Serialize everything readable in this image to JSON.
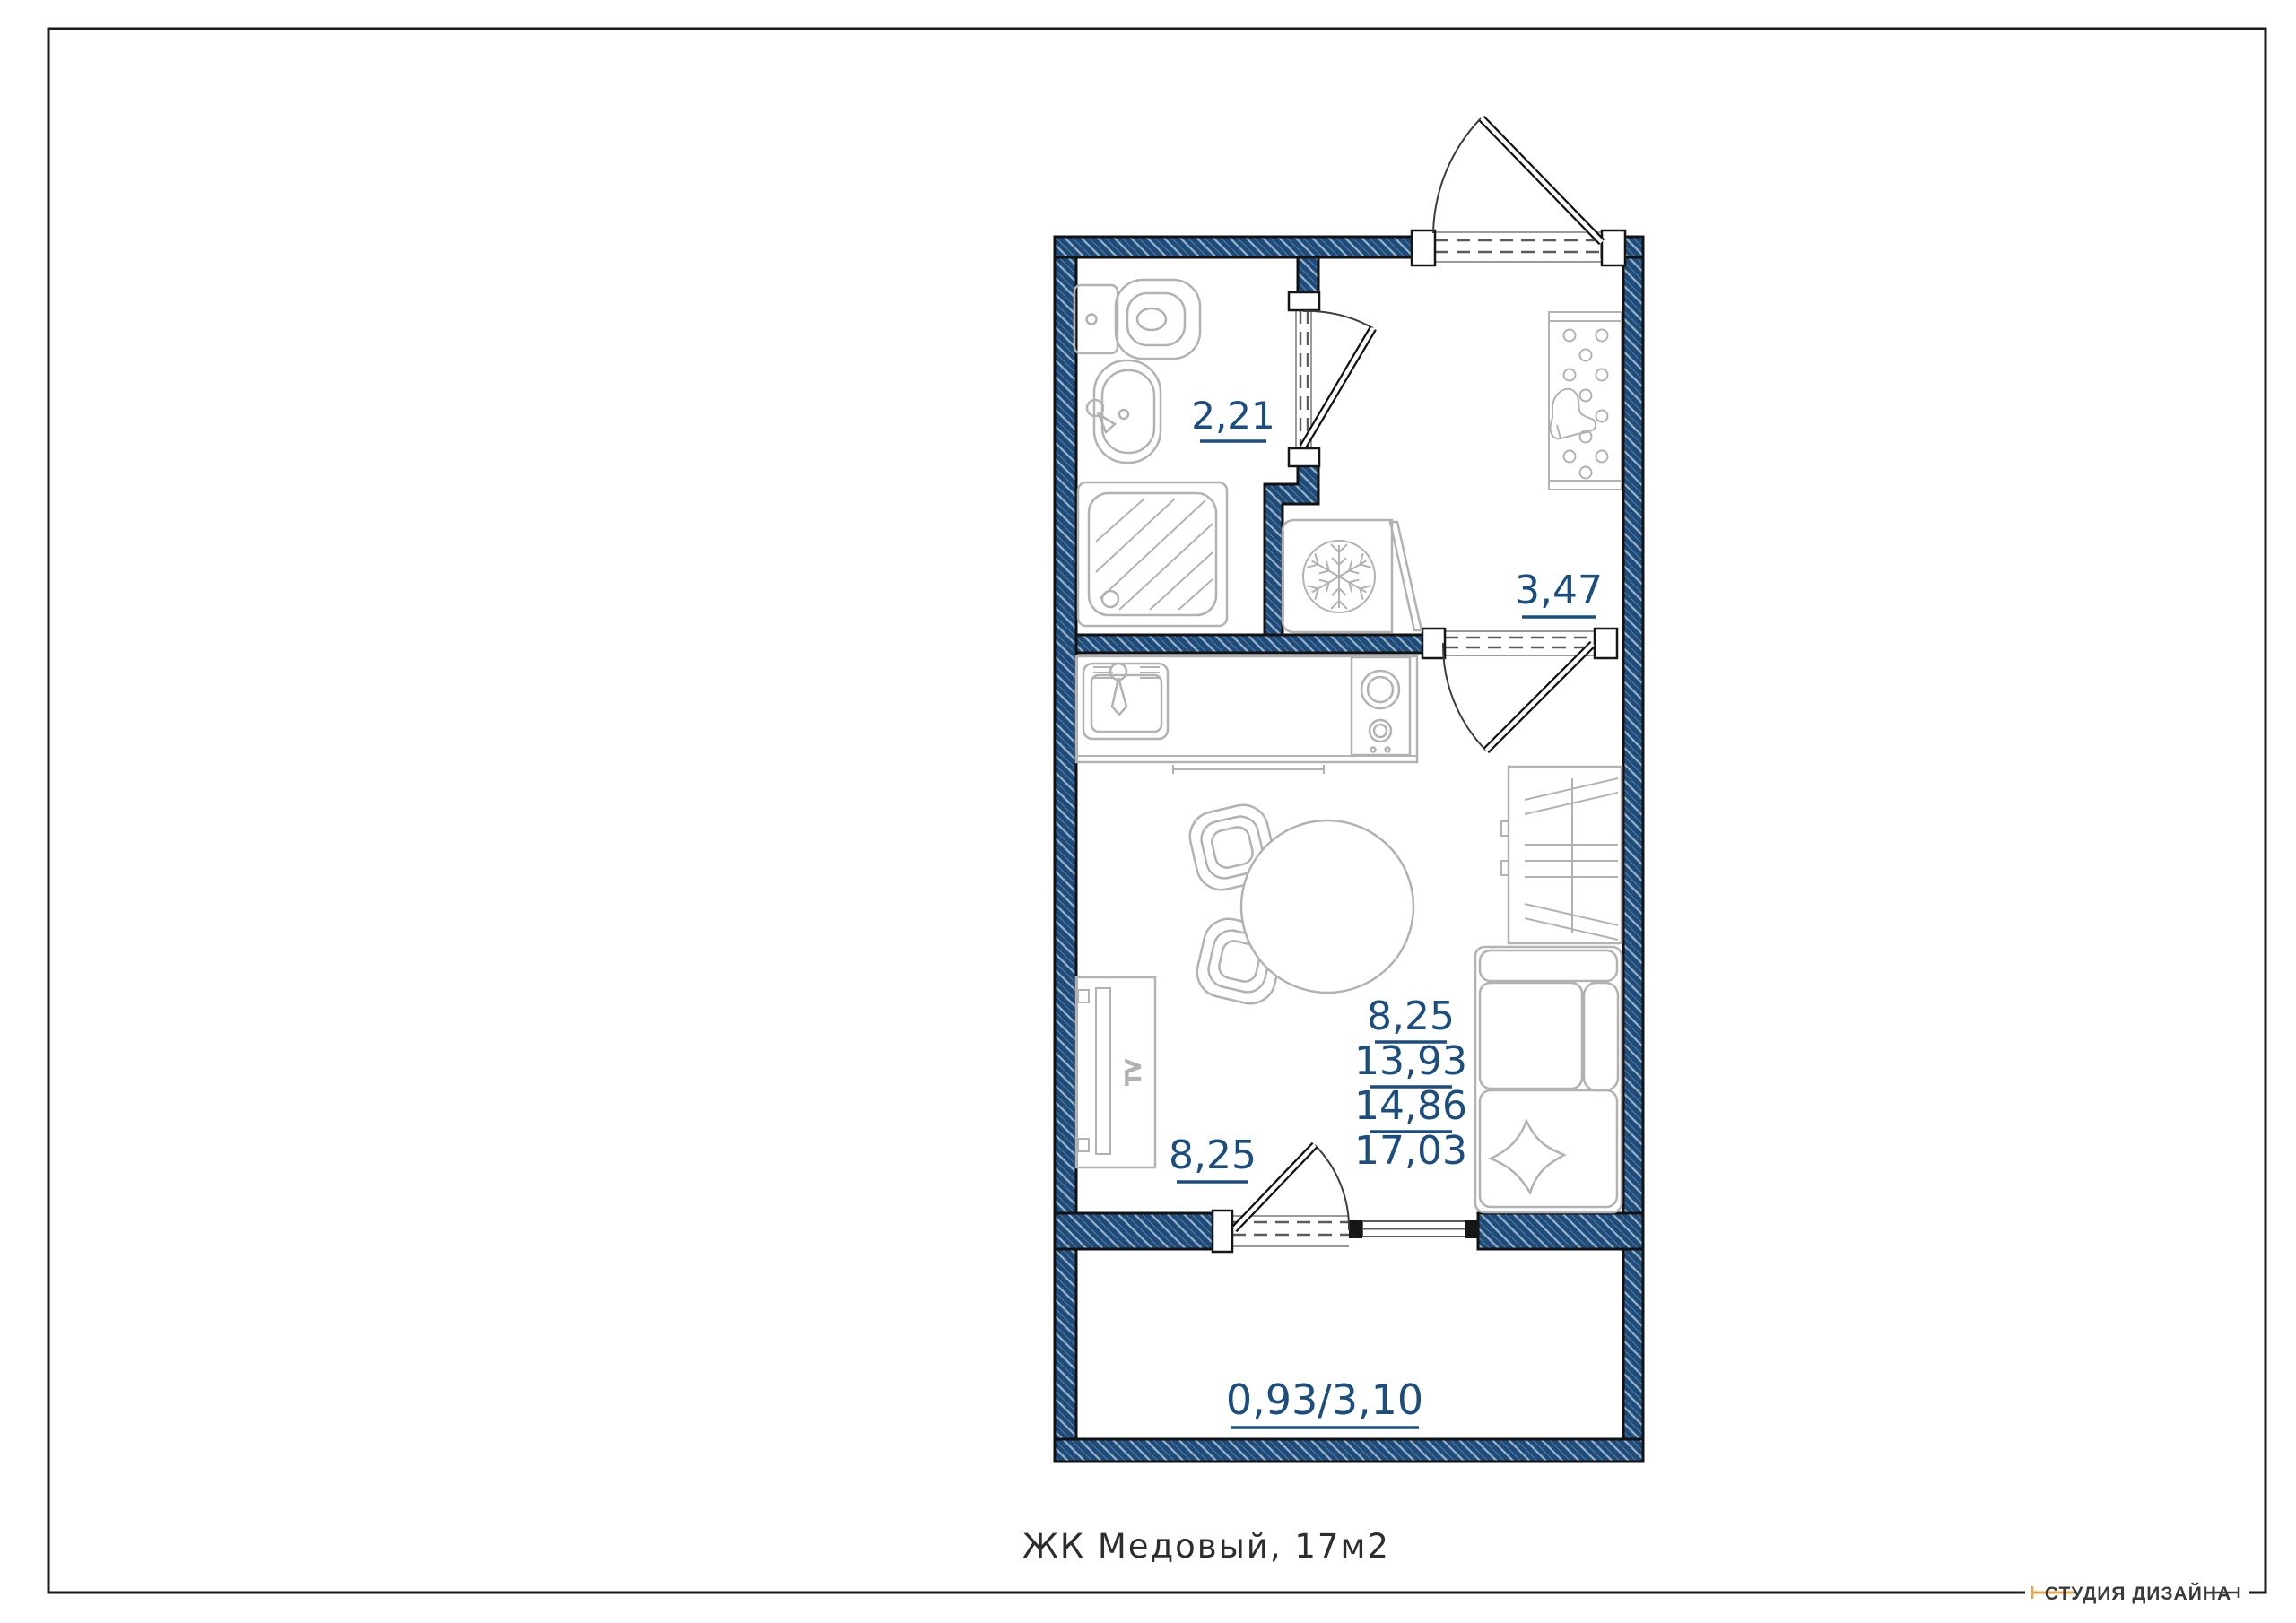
{
  "title": "ЖК  Медовый,  17м2",
  "logo": {
    "studio": "СТУДИЯ ДИЗАЙНА"
  },
  "labels": {
    "bathroom": "2,21",
    "hallway": "3,47",
    "living": "8,25",
    "stack": [
      "8,25",
      "13,93",
      "14,86",
      "17,03"
    ],
    "balcony": "0,93/3,10",
    "tv": "TV"
  },
  "colors": {
    "wall": "#1d4b7a",
    "hatch_line": "#9db3c9",
    "label_text": "#1b4e7e",
    "furniture_line": "#b2b2b2",
    "accent_orange": "#e8a449",
    "frame": "#1a1a1a"
  }
}
